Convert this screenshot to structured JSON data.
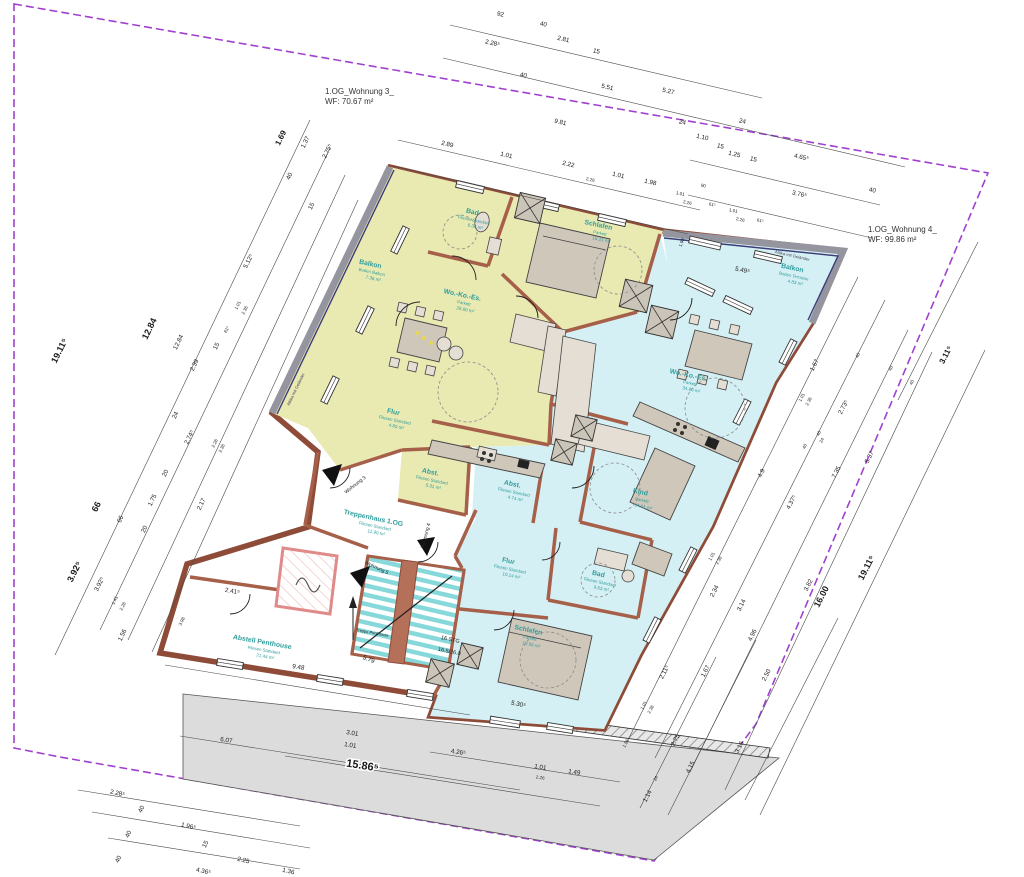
{
  "titles": {
    "apartment3_line1": "1.OG_Wohnung 3_",
    "apartment3_line2": "WF: 70.67 m²",
    "apartment4_line1": "1.OG_Wohnung 4_",
    "apartment4_line2": "WF: 99.86 m²"
  },
  "colors": {
    "apartment3_fill": "#e9e9b2",
    "apartment4_fill": "#d5f0f4",
    "wall": "#8d4b38",
    "room_label": "#2f9d9d",
    "boundary": "#a040d0",
    "parapet": "#95959f",
    "driveway": "#dcdcdc"
  },
  "rooms": [
    {
      "name": "Balkon",
      "floor": "Boden Balkon",
      "area": "7.36 m²",
      "x": 370,
      "y": 266,
      "r": 12
    },
    {
      "name": "Bad",
      "floor": "Fliesen Standard",
      "area": "6.36 m²",
      "x": 472,
      "y": 214,
      "r": 12
    },
    {
      "name": "Schlafen",
      "floor": "Parkett",
      "area": "18.21 m²",
      "x": 598,
      "y": 227,
      "r": 12
    },
    {
      "name": "Wo.-Ko.-Es.",
      "floor": "Parkett",
      "area": "28.80 m²",
      "x": 462,
      "y": 297,
      "r": 12
    },
    {
      "name": "Flur",
      "floor": "Fliesen Standard",
      "area": "4.80 m²",
      "x": 393,
      "y": 414,
      "r": 12
    },
    {
      "name": "Abst.",
      "floor": "Fliesen Standard",
      "area": "5.31 m²",
      "x": 430,
      "y": 474,
      "r": 12
    },
    {
      "name": "Treppenhaus 1.OG",
      "floor": "Fliesen Standard",
      "area": "11.90 m²",
      "x": 373,
      "y": 520,
      "r": 12
    },
    {
      "name": "Abstell Penthouse",
      "floor": "Fliesen Standard",
      "area": "21.44 m²",
      "x": 262,
      "y": 644,
      "r": 10
    },
    {
      "name": "Balkon",
      "floor": "Boden Terrasse",
      "area": "4.83 m²",
      "x": 792,
      "y": 270,
      "r": 12
    },
    {
      "name": "Wo.-Ko.-Es.",
      "floor": "Parkett",
      "area": "34.80 m²",
      "x": 688,
      "y": 377,
      "r": 12
    },
    {
      "name": "Kind",
      "floor": "Parkett",
      "area": "14.01 m²",
      "x": 640,
      "y": 494,
      "r": 12
    },
    {
      "name": "Bad",
      "floor": "Fliesen Standard",
      "area": "9.63 m²",
      "x": 598,
      "y": 576,
      "r": 12
    },
    {
      "name": "Flur",
      "floor": "Fliesen Standard",
      "area": "10.14 m²",
      "x": 508,
      "y": 563,
      "r": 12
    },
    {
      "name": "Abst.",
      "floor": "Fliesen Standard",
      "area": "4.74 m²",
      "x": 512,
      "y": 486,
      "r": 12
    },
    {
      "name": "Schlafen",
      "floor": "Parkett",
      "area": "19.56 m²",
      "x": 528,
      "y": 632,
      "r": 12
    }
  ],
  "annotations": [
    {
      "t": "Attika mit Geländer",
      "x": 297,
      "y": 390,
      "r": -64,
      "s": 4.2,
      "c": "#44445a"
    },
    {
      "t": "Attika mit Geländer",
      "x": 792,
      "y": 257,
      "r": 13,
      "s": 4.2,
      "c": "#44445a"
    },
    {
      "t": "Wohnung 3",
      "x": 356,
      "y": 486,
      "r": -38,
      "s": 5,
      "c": "#222"
    },
    {
      "t": "Wohnung 4",
      "x": 427,
      "y": 536,
      "r": -75,
      "s": 5,
      "c": "#222"
    },
    {
      "t": "Wohnung 5",
      "x": 376,
      "y": 569,
      "r": 25,
      "s": 5,
      "c": "#222"
    },
    {
      "t": "Treppe Penthouse",
      "x": 372,
      "y": 634,
      "r": 10,
      "s": 4,
      "c": "#222"
    },
    {
      "t": "16 STG",
      "x": 450,
      "y": 641,
      "r": 12,
      "s": 5.5,
      "c": "#222"
    },
    {
      "t": "16.5/26.0",
      "x": 449,
      "y": 653,
      "r": 12,
      "s": 5.5,
      "c": "#222"
    }
  ],
  "dimensions": [
    {
      "t": "92",
      "x": 500,
      "y": 16,
      "r": 13
    },
    {
      "t": "40",
      "x": 543,
      "y": 26,
      "r": 13
    },
    {
      "t": "2.28⁵",
      "x": 492,
      "y": 45,
      "r": 13
    },
    {
      "t": "2.81",
      "x": 563,
      "y": 41,
      "r": 13
    },
    {
      "t": "40",
      "x": 523,
      "y": 77,
      "r": 13
    },
    {
      "t": "15",
      "x": 596,
      "y": 53,
      "r": 13
    },
    {
      "t": "5.51",
      "x": 607,
      "y": 89,
      "r": 13
    },
    {
      "t": "5.27",
      "x": 668,
      "y": 93,
      "r": 13
    },
    {
      "t": "24",
      "x": 682,
      "y": 124,
      "r": 13
    },
    {
      "t": "1.10",
      "x": 702,
      "y": 139,
      "r": 13
    },
    {
      "t": "15",
      "x": 720,
      "y": 148,
      "r": 13
    },
    {
      "t": "24",
      "x": 742,
      "y": 123,
      "r": 13
    },
    {
      "t": "1.25",
      "x": 734,
      "y": 156,
      "r": 13
    },
    {
      "t": "15",
      "x": 753,
      "y": 161,
      "r": 13
    },
    {
      "t": "4.65⁵",
      "x": 801,
      "y": 159,
      "r": 13
    },
    {
      "t": "3.76⁵",
      "x": 799,
      "y": 196,
      "r": 13
    },
    {
      "t": "40",
      "x": 872,
      "y": 192,
      "r": 13
    },
    {
      "t": "9.81",
      "x": 560,
      "y": 124,
      "r": 13
    },
    {
      "t": "2.89",
      "x": 447,
      "y": 146,
      "r": 13
    },
    {
      "t": "1.01",
      "x": 506,
      "y": 157,
      "r": 13
    },
    {
      "t": "2.22",
      "x": 568,
      "y": 166,
      "r": 13
    },
    {
      "t": "2.26",
      "x": 590,
      "y": 181,
      "r": 13,
      "s": 4.5
    },
    {
      "t": "1.01",
      "x": 618,
      "y": 177,
      "r": 13
    },
    {
      "t": "1.98",
      "x": 650,
      "y": 184,
      "r": 13
    },
    {
      "t": "90",
      "x": 703,
      "y": 187,
      "r": 13,
      "s": 4.5
    },
    {
      "t": "1.01",
      "x": 680,
      "y": 195,
      "r": 13,
      "s": 4.5
    },
    {
      "t": "2.26",
      "x": 687,
      "y": 204,
      "r": 13,
      "s": 4.5
    },
    {
      "t": "61⁵",
      "x": 712,
      "y": 206,
      "r": 13,
      "s": 4.5
    },
    {
      "t": "1.01",
      "x": 733,
      "y": 212,
      "r": 13,
      "s": 4.5
    },
    {
      "t": "2.26",
      "x": 740,
      "y": 221,
      "r": 13,
      "s": 4.5
    },
    {
      "t": "61⁵",
      "x": 760,
      "y": 222,
      "r": 13,
      "s": 4.5
    },
    {
      "t": "1.90",
      "x": 683,
      "y": 243,
      "r": -70,
      "s": 4.5
    },
    {
      "t": "5.49⁵",
      "x": 742,
      "y": 272,
      "r": 13
    },
    {
      "t": "1.69",
      "x": 283,
      "y": 139,
      "r": -64,
      "b": 1,
      "s": 8
    },
    {
      "t": "1.37",
      "x": 307,
      "y": 143,
      "r": -64
    },
    {
      "t": "2.75⁵",
      "x": 329,
      "y": 152,
      "r": -64
    },
    {
      "t": "40",
      "x": 291,
      "y": 177,
      "r": -64
    },
    {
      "t": "15",
      "x": 313,
      "y": 207,
      "r": -64
    },
    {
      "t": "5.12⁵",
      "x": 250,
      "y": 262,
      "r": -64
    },
    {
      "t": "19.11⁵",
      "x": 62,
      "y": 352,
      "r": -64,
      "b": 1,
      "s": 9
    },
    {
      "t": "12.84",
      "x": 152,
      "y": 330,
      "r": -64,
      "b": 1,
      "s": 9
    },
    {
      "t": "12.84",
      "x": 180,
      "y": 343,
      "r": -64
    },
    {
      "t": "15",
      "x": 218,
      "y": 347,
      "r": -64
    },
    {
      "t": "2.39",
      "x": 196,
      "y": 366,
      "r": -64
    },
    {
      "t": "24",
      "x": 177,
      "y": 416,
      "r": -64
    },
    {
      "t": "1.01",
      "x": 239,
      "y": 306,
      "r": -64,
      "s": 4.5
    },
    {
      "t": "2.36",
      "x": 246,
      "y": 311,
      "r": -64,
      "s": 4.5
    },
    {
      "t": "61⁵",
      "x": 228,
      "y": 330,
      "r": -64,
      "s": 4.5
    },
    {
      "t": "66",
      "x": 99,
      "y": 508,
      "r": -64,
      "b": 1,
      "s": 9
    },
    {
      "t": "66",
      "x": 122,
      "y": 520,
      "r": -64
    },
    {
      "t": "3.92⁵",
      "x": 77,
      "y": 573,
      "r": -64,
      "b": 1,
      "s": 9
    },
    {
      "t": "3.92⁵",
      "x": 101,
      "y": 585,
      "r": -64
    },
    {
      "t": "1.75",
      "x": 154,
      "y": 501,
      "r": -64
    },
    {
      "t": "20",
      "x": 167,
      "y": 474,
      "r": -64
    },
    {
      "t": "2.74⁵",
      "x": 191,
      "y": 438,
      "r": -64
    },
    {
      "t": "2.26",
      "x": 216,
      "y": 444,
      "r": -64,
      "s": 4.5
    },
    {
      "t": "2.36",
      "x": 223,
      "y": 449,
      "r": -64,
      "s": 4.5
    },
    {
      "t": "2.17",
      "x": 203,
      "y": 505,
      "r": -64
    },
    {
      "t": "20",
      "x": 146,
      "y": 530,
      "r": -64
    },
    {
      "t": "1.41",
      "x": 116,
      "y": 601,
      "r": -64,
      "s": 4.5
    },
    {
      "t": "2.26",
      "x": 124,
      "y": 607,
      "r": -64,
      "s": 4.5
    },
    {
      "t": "1.56",
      "x": 124,
      "y": 636,
      "r": -64
    },
    {
      "t": "3.98",
      "x": 183,
      "y": 622,
      "r": -64,
      "s": 4.5
    },
    {
      "t": "2.41⁵",
      "x": 232,
      "y": 593,
      "r": 10
    },
    {
      "t": "2.28⁵",
      "x": 117,
      "y": 795,
      "r": 13
    },
    {
      "t": "40",
      "x": 143,
      "y": 810,
      "r": -64
    },
    {
      "t": "40",
      "x": 130,
      "y": 835,
      "r": -64
    },
    {
      "t": "40",
      "x": 120,
      "y": 860,
      "r": -64
    },
    {
      "t": "1.96⁵",
      "x": 188,
      "y": 828,
      "r": 13
    },
    {
      "t": "15",
      "x": 207,
      "y": 845,
      "r": -64
    },
    {
      "t": "2.25",
      "x": 243,
      "y": 862,
      "r": 13
    },
    {
      "t": "4.36⁵",
      "x": 203,
      "y": 873,
      "r": 13
    },
    {
      "t": "1.36",
      "x": 288,
      "y": 873,
      "r": 13
    },
    {
      "t": "6.07",
      "x": 226,
      "y": 742,
      "r": 9
    },
    {
      "t": "3.01",
      "x": 352,
      "y": 735,
      "r": 9
    },
    {
      "t": "1.01",
      "x": 350,
      "y": 747,
      "r": 9
    },
    {
      "t": "15.86⁵",
      "x": 362,
      "y": 769,
      "r": 9,
      "b": 1,
      "s": 11,
      "bg": 1
    },
    {
      "t": "9.48",
      "x": 298,
      "y": 669,
      "r": 9
    },
    {
      "t": "5.79",
      "x": 368,
      "y": 661,
      "r": 22
    },
    {
      "t": "5.30⁵",
      "x": 518,
      "y": 706,
      "r": 12
    },
    {
      "t": "4.26⁵",
      "x": 458,
      "y": 754,
      "r": 9
    },
    {
      "t": "1.01",
      "x": 540,
      "y": 769,
      "r": 9
    },
    {
      "t": "2.26",
      "x": 540,
      "y": 779,
      "r": 9,
      "s": 4.5
    },
    {
      "t": "1.49",
      "x": 574,
      "y": 774,
      "r": 9
    },
    {
      "t": "1.14",
      "x": 649,
      "y": 797,
      "r": -63
    },
    {
      "t": "24",
      "x": 657,
      "y": 779,
      "r": -63,
      "s": 4.5
    },
    {
      "t": "4.15",
      "x": 692,
      "y": 768,
      "r": -63
    },
    {
      "t": "2.75",
      "x": 677,
      "y": 741,
      "r": -63
    },
    {
      "t": "3.16",
      "x": 741,
      "y": 748,
      "r": -63
    },
    {
      "t": "1.56",
      "x": 627,
      "y": 744,
      "r": -63,
      "s": 4.5
    },
    {
      "t": "2.11⁵",
      "x": 666,
      "y": 673,
      "r": -63
    },
    {
      "t": "1.01",
      "x": 645,
      "y": 706,
      "r": -63,
      "s": 4.5
    },
    {
      "t": "2.36",
      "x": 652,
      "y": 710,
      "r": -63,
      "s": 4.5
    },
    {
      "t": "1.67",
      "x": 707,
      "y": 672,
      "r": -63
    },
    {
      "t": "2.50",
      "x": 768,
      "y": 676,
      "r": -63
    },
    {
      "t": "4.96",
      "x": 754,
      "y": 636,
      "r": -63
    },
    {
      "t": "3.14",
      "x": 743,
      "y": 606,
      "r": -63
    },
    {
      "t": "2.34",
      "x": 716,
      "y": 592,
      "r": -63
    },
    {
      "t": "3.82",
      "x": 810,
      "y": 586,
      "r": -63
    },
    {
      "t": "16.00",
      "x": 824,
      "y": 598,
      "r": -63,
      "b": 1,
      "s": 9
    },
    {
      "t": "19.11⁵",
      "x": 869,
      "y": 569,
      "r": -63,
      "b": 1,
      "s": 9
    },
    {
      "t": "7.35",
      "x": 838,
      "y": 473,
      "r": -63
    },
    {
      "t": "5.37",
      "x": 871,
      "y": 458,
      "r": -63
    },
    {
      "t": "4.37⁵",
      "x": 793,
      "y": 503,
      "r": -63
    },
    {
      "t": "4.9",
      "x": 763,
      "y": 474,
      "r": -63
    },
    {
      "t": "40",
      "x": 806,
      "y": 447,
      "r": -63,
      "s": 4.5
    },
    {
      "t": "40",
      "x": 820,
      "y": 434,
      "r": -63,
      "s": 4.5
    },
    {
      "t": "1.01",
      "x": 713,
      "y": 557,
      "r": -63,
      "s": 4.5
    },
    {
      "t": "2.36",
      "x": 720,
      "y": 561,
      "r": -63,
      "s": 4.5
    },
    {
      "t": "2.73⁵",
      "x": 845,
      "y": 408,
      "r": -63
    },
    {
      "t": "24",
      "x": 823,
      "y": 441,
      "r": -63,
      "s": 4.5
    },
    {
      "t": "1.67",
      "x": 816,
      "y": 366,
      "r": -63
    },
    {
      "t": "1.01",
      "x": 803,
      "y": 398,
      "r": -63,
      "s": 4.5
    },
    {
      "t": "2.36",
      "x": 810,
      "y": 402,
      "r": -63,
      "s": 4.5
    },
    {
      "t": "40",
      "x": 859,
      "y": 356,
      "r": -63,
      "s": 4.5
    },
    {
      "t": "40",
      "x": 892,
      "y": 369,
      "r": -63,
      "s": 4.5
    },
    {
      "t": "40",
      "x": 913,
      "y": 383,
      "r": -63,
      "s": 4.5
    },
    {
      "t": "3.11⁵",
      "x": 948,
      "y": 356,
      "r": -63,
      "b": 1,
      "s": 8
    }
  ]
}
